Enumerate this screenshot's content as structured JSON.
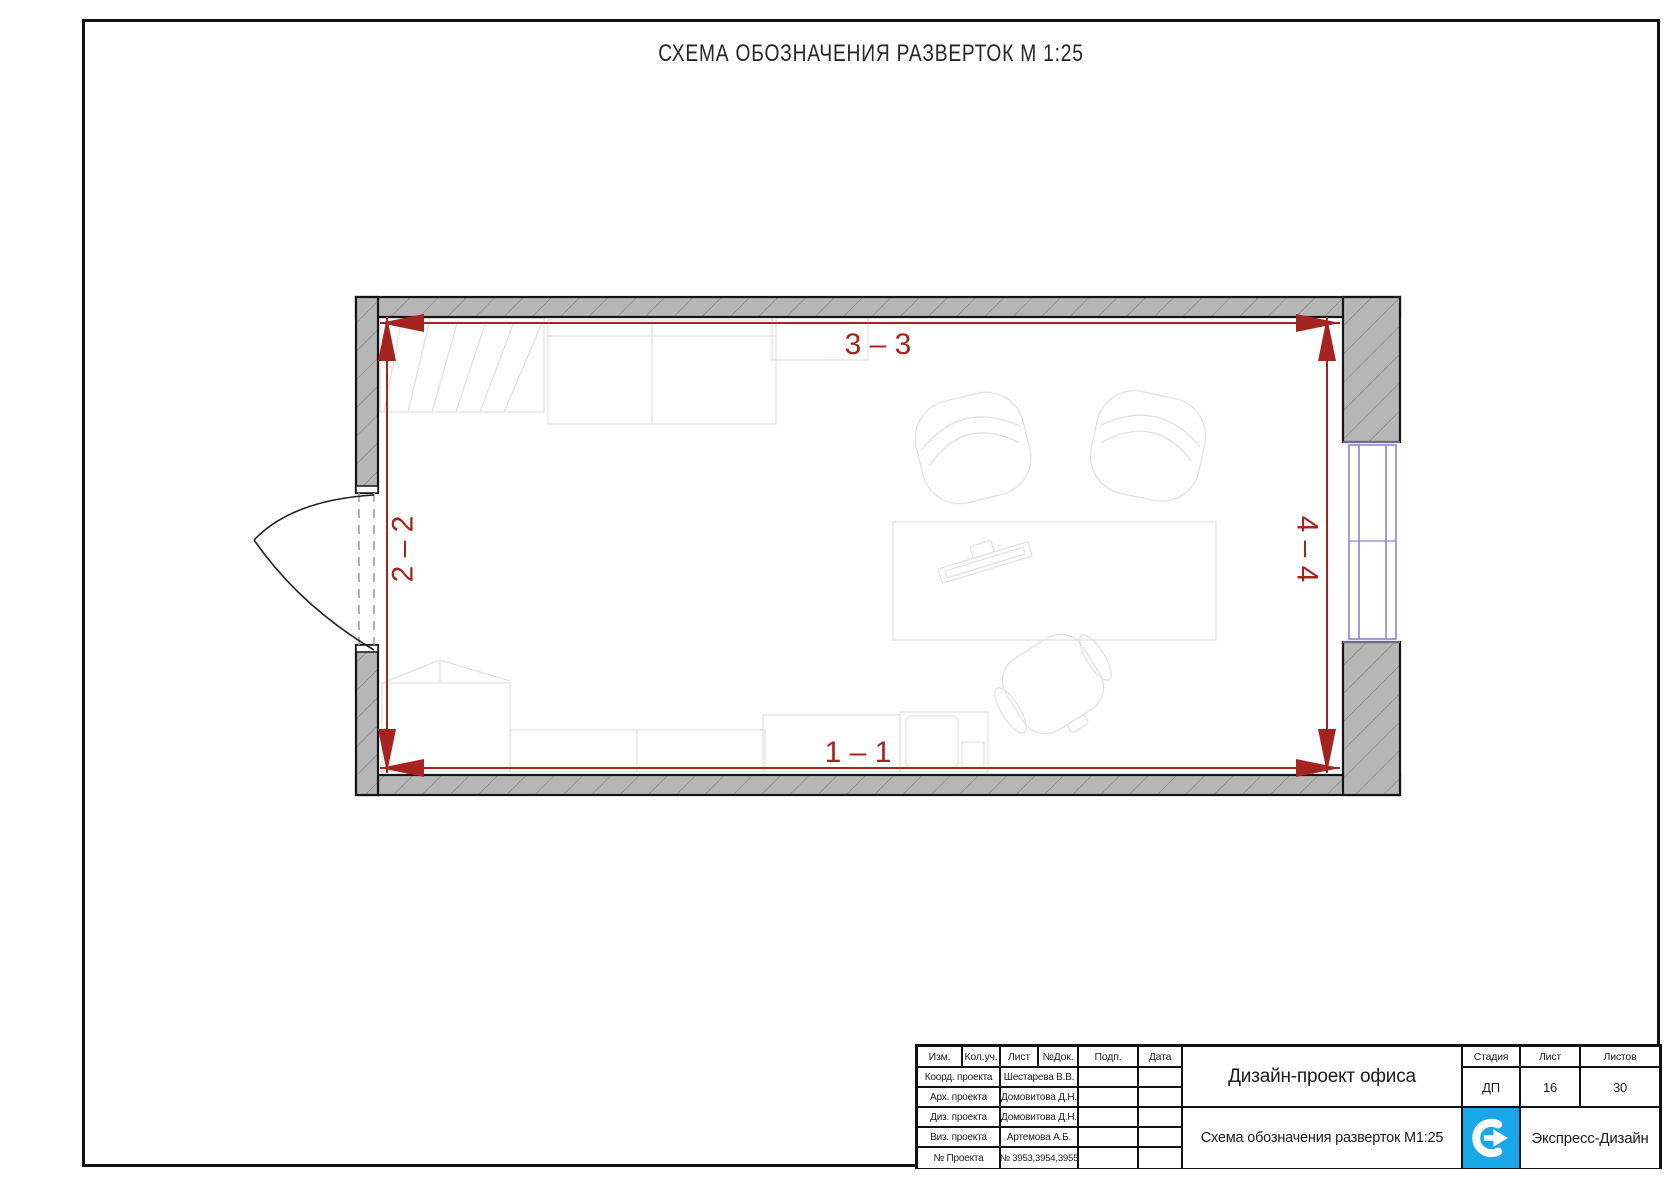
{
  "sheet": {
    "title": "СХЕМА ОБОЗНАЧЕНИЯ РАЗВЕРТОК М 1:25"
  },
  "plan": {
    "markers": {
      "top": "3 – 3",
      "bottom": "1 – 1",
      "left": "2 – 2",
      "right": "4 – 4"
    }
  },
  "title_block": {
    "header_cols": [
      "Изм.",
      "Кол.уч.",
      "Лист",
      "№Док.",
      "Подп.",
      "Дата"
    ],
    "rows": [
      {
        "label": "Коорд. проекта",
        "value": "Шестарева В.В."
      },
      {
        "label": "Арх. проекта",
        "value": "Домовитова Д.Н."
      },
      {
        "label": "Диз. проекта",
        "value": "Домовитова Д.Н."
      },
      {
        "label": "Виз. проекта",
        "value": "Артемова А.Б."
      },
      {
        "label": "№ Проекта",
        "value": "№ 3953,3954,3955"
      }
    ],
    "project_title": "Дизайн-проект офиса",
    "sheet_title": "Схема обозначения разверток М1:25",
    "stage_header": "Стадия",
    "stage_value": "ДП",
    "sheet_header": "Лист",
    "sheet_value": "16",
    "sheets_header": "Листов",
    "sheets_value": "30",
    "company": "Экспресс-Дизайн"
  },
  "colors": {
    "dimension_red": "#a32420",
    "wall_fill": "#b6b6b6",
    "wall_hatch": "#7e7e7e",
    "window_blue": "#8787cd",
    "logo_blue": "#18a7e8",
    "furniture_gray": "#e1e1e1"
  }
}
